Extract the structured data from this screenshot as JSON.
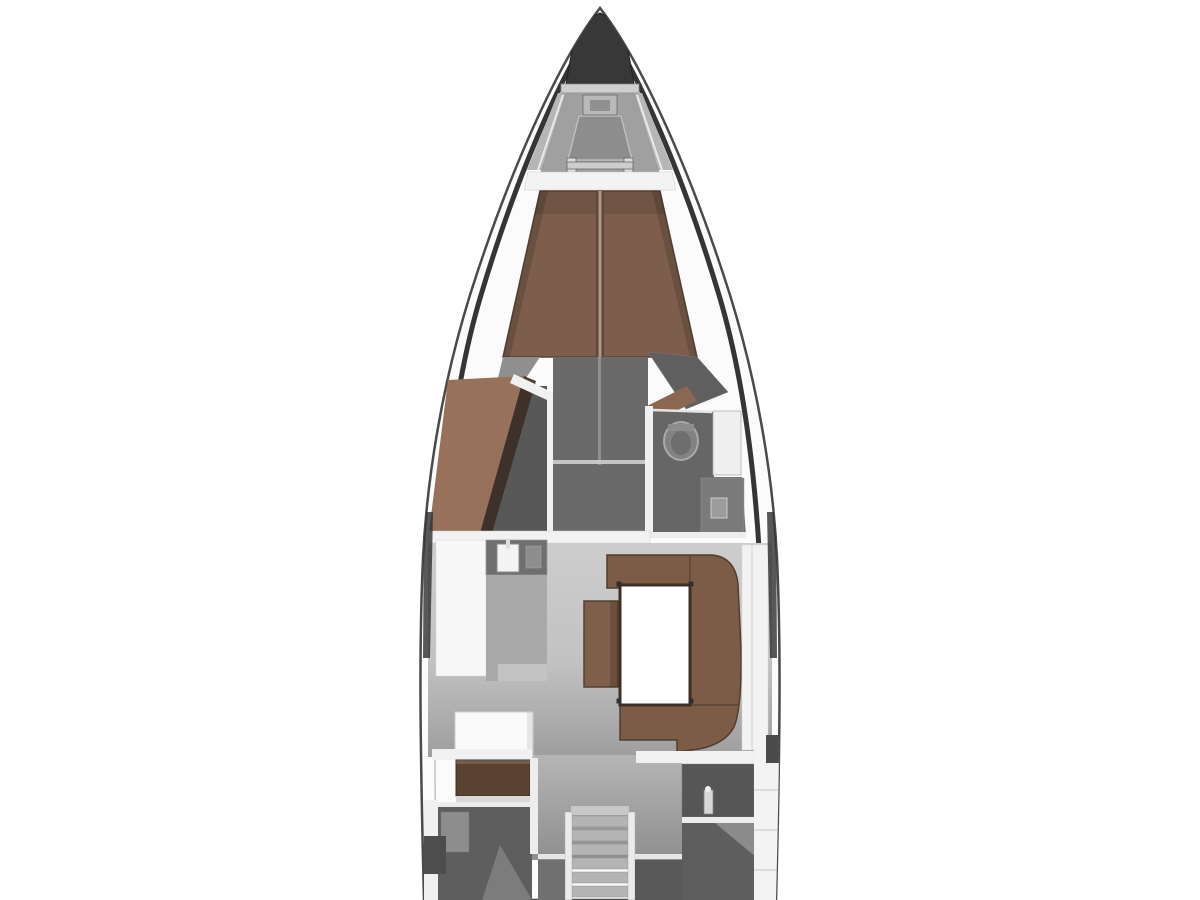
{
  "image": {
    "kind": "yacht-floor-plan",
    "description": "Top-down 3D-rendered interior layout plan of a sailing yacht: bow anchor locker and foredeck hatch, forward V-berth cabin with wardrobe and en-suite head, salon with galley, U-shaped settee and table, chart table, companionway stairs and two aft cabins with aft head",
    "background": "#ffffff"
  },
  "parts": {
    "bow": [
      "anchor-locker",
      "bow-hatch",
      "foredeck-hatch",
      "windlass"
    ],
    "forward_cabin": [
      "v-berth-bed",
      "wardrobe",
      "forward-head",
      "toilet",
      "vanity-sink"
    ],
    "salon": [
      "galley-sink",
      "galley-counter",
      "galley-island",
      "u-shaped-settee",
      "salon-table",
      "seat-chest"
    ],
    "aft": [
      "chart-table",
      "port-aft-berth",
      "companionway-stairs",
      "aft-head",
      "starboard-aft-berth"
    ]
  },
  "colors": {
    "hull_white": "#fbfbfb",
    "anchor_locker": "#383838",
    "foredeck": "#a0a0a0",
    "deck_band": "#f3f3f3",
    "bed": "#7d5e4c",
    "bed_seam_light": "#b29785",
    "bed_seam_dark": "#5c463a",
    "wardrobe": "#97715a",
    "fwd_floor": "#6a6a6a",
    "head_floor": "#666666",
    "toilet": "#828282",
    "bulkhead": "#f2f2f2",
    "galley_counter": "#f7f7f7",
    "galley_sink_unit": "#6f6f6f",
    "galley_gray": "#a9a9a9",
    "sofa": "#7d5c47",
    "table": "#fefefe",
    "table_border": "#3e2f24",
    "stool": "#7f5f49",
    "chart_table": "#5a4130",
    "aft_berth": "#5e5e5e",
    "aft_head_dark": "#565656",
    "stairs": "#b4b4b4",
    "locker_white": "#f3f3f3",
    "window_dark": "#2f2f2f",
    "door_wood": "#8a6750"
  }
}
